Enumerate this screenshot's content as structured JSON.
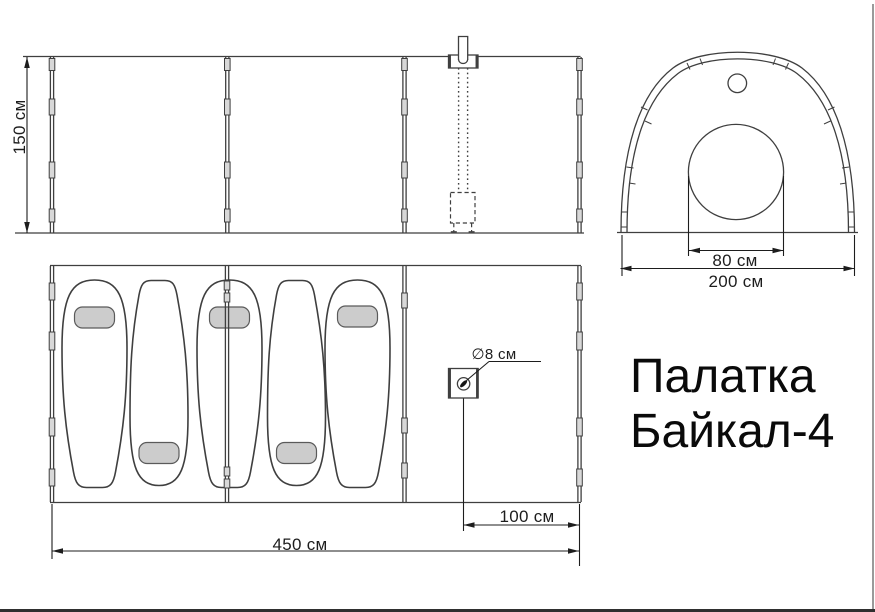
{
  "title": {
    "line1": "Палатка",
    "line2": "Байкал-4"
  },
  "side_view": {
    "height_label": "150 см"
  },
  "end_view": {
    "door_width_label": "80 см",
    "width_label": "200 см"
  },
  "floor_plan": {
    "pipe_diameter_label": "∅8 см",
    "stove_offset_label": "100 см",
    "length_label": "450 см"
  },
  "colors": {
    "line": "#3f3f3f",
    "dim": "#1d1d1d",
    "pillow": "#cccccc",
    "background": "#ffffff",
    "border": "#2f2f2f",
    "title_text": "#0a0a0a"
  }
}
